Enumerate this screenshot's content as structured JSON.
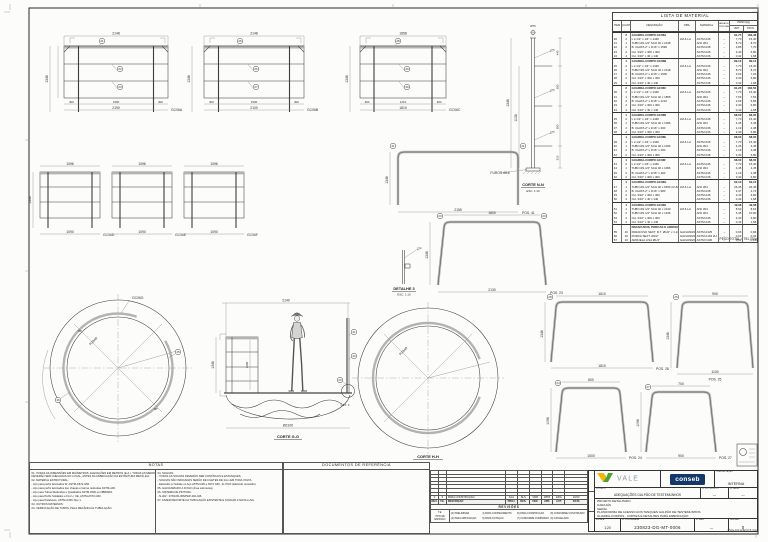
{
  "mat": {
    "title": "LISTA DE MATERIAL",
    "h_item": "ITEM",
    "h_qty": "QUANT.",
    "h_desc": "DESCRIÇÃO",
    "h_obs": "OBS.",
    "h_mat": "MATERIAL",
    "h_area": "ÁREA DE PINTURA",
    "h_peso": "PESO (kg)",
    "h_unit": "UNIT.",
    "h_total": "TOTAL",
    "groups": [
      {
        "qty": "2",
        "name": "GUARDA-CORPO GC06A",
        "unit": "91,74",
        "total": "183,48",
        "rows": [
          [
            "20",
            "2",
            "L 2.1/2\" x 1/4\" x 1346",
            "LM & LA",
            "ASTM A36",
            "–",
            "7,70",
            "15,40"
          ],
          [
            "21",
            "1",
            "TUBO Ø1.1/2\" SCH 40 x 2148",
            "",
            "AISI 304",
            "–",
            "8,70",
            "8,70"
          ],
          [
            "22",
            "2",
            "B. CHATA 2\" x 3/16\" x 1590",
            "",
            "ASTM A36",
            "–",
            "3,85",
            "7,70"
          ],
          [
            "23",
            "2",
            "CH. 3/16\" x 300 x 300",
            "",
            "ASTM A36",
            "–",
            "3,40",
            "6,80"
          ],
          [
            "24",
            "4",
            "CH. 3/16\" x 40 x 140",
            "",
            "ASTM A36",
            "–",
            "0,42",
            "1,68"
          ]
        ]
      },
      {
        "qty": "1",
        "name": "GUARDA-CORPO GC06B",
        "unit": "89,10",
        "total": "89,10",
        "rows": [
          [
            "25",
            "2",
            "L 2.1/2\" x 1/4\" x 1346",
            "LM & LA",
            "ASTM A36",
            "–",
            "7,70",
            "15,40"
          ],
          [
            "26",
            "1",
            "TUBO Ø1.1/2\" SCH 40 x 2148",
            "",
            "AISI 304",
            "–",
            "8,70",
            "8,70"
          ],
          [
            "27",
            "2",
            "B. CHATA 2\" x 3/16\" x 1500",
            "",
            "ASTM A36",
            "–",
            "3,63",
            "7,26"
          ],
          [
            "28",
            "2",
            "CH. 3/16\" x 300 x 300",
            "",
            "ASTM A36",
            "–",
            "3,40",
            "6,80"
          ],
          [
            "29",
            "4",
            "CH. 3/16\" x 40 x 140",
            "",
            "ASTM A36",
            "–",
            "0,42",
            "1,68"
          ]
        ]
      },
      {
        "qty": "2",
        "name": "GUARDA-CORPO GC06C",
        "unit": "81,25",
        "total": "162,50",
        "rows": [
          [
            "30",
            "2",
            "L 2.1/2\" x 1/4\" x 1346",
            "LM & LA",
            "ASTM A36",
            "–",
            "7,70",
            "15,40"
          ],
          [
            "31",
            "1",
            "TUBO Ø1.1/2\" SCH 40 x 1858",
            "",
            "AISI 304",
            "–",
            "7,53",
            "7,53"
          ],
          [
            "32",
            "2",
            "B. CHATA 2\" x 3/16\" x 1210",
            "",
            "ASTM A36",
            "–",
            "2,93",
            "5,86"
          ],
          [
            "33",
            "2",
            "CH. 3/16\" x 300 x 300",
            "",
            "ASTM A36",
            "–",
            "3,40",
            "6,80"
          ],
          [
            "34",
            "4",
            "CH. 3/16\" x 40 x 140",
            "",
            "ASTM A36",
            "–",
            "0,42",
            "1,68"
          ]
        ]
      },
      {
        "qty": "1",
        "name": "GUARDA-CORPO GC06D",
        "unit": "68,00",
        "total": "68,00",
        "rows": [
          [
            "35",
            "2",
            "L 2.1/2\" x 1/4\" x 1346",
            "LM & LA",
            "ASTM A36",
            "–",
            "7,70",
            "15,40"
          ],
          [
            "36",
            "1",
            "TUBO Ø1.1/2\" SCH 40 x 1096",
            "",
            "AISI 304",
            "–",
            "4,45",
            "4,45"
          ],
          [
            "37",
            "2",
            "B. CHATA 2\" x 3/16\" x 490",
            "",
            "ASTM A36",
            "–",
            "1,19",
            "2,38"
          ],
          [
            "38",
            "2",
            "CH. 3/16\" x 300 x 300",
            "",
            "ASTM A36",
            "–",
            "3,40",
            "6,80"
          ]
        ]
      },
      {
        "qty": "1",
        "name": "GUARDA-CORPO GC06E",
        "unit": "68,00",
        "total": "68,00",
        "rows": [
          [
            "39",
            "2",
            "L 2.1/2\" x 1/4\" x 1346",
            "LM & LA",
            "ASTM A36",
            "–",
            "7,70",
            "15,40"
          ],
          [
            "40",
            "1",
            "TUBO Ø1.1/2\" SCH 40 x 1096",
            "",
            "AISI 304",
            "–",
            "4,45",
            "4,45"
          ],
          [
            "41",
            "2",
            "B. CHATA 2\" x 3/16\" x 490",
            "",
            "ASTM A36",
            "–",
            "1,19",
            "2,38"
          ],
          [
            "42",
            "2",
            "CH. 3/16\" x 300 x 300",
            "",
            "ASTM A36",
            "–",
            "3,40",
            "6,80"
          ]
        ]
      },
      {
        "qty": "1",
        "name": "GUARDA-CORPO GC06F",
        "unit": "68,00",
        "total": "68,00",
        "rows": [
          [
            "43",
            "2",
            "L 2.1/2\" x 1/4\" x 1346",
            "LM & LA",
            "ASTM A36",
            "–",
            "7,70",
            "15,40"
          ],
          [
            "44",
            "1",
            "TUBO Ø1.1/2\" SCH 40 x 1096",
            "",
            "AISI 304",
            "–",
            "4,45",
            "4,45"
          ],
          [
            "45",
            "2",
            "B. CHATA 2\" x 3/16\" x 490",
            "",
            "ASTM A36",
            "–",
            "1,19",
            "2,38"
          ],
          [
            "46",
            "2",
            "CH. 3/16\" x 300 x 300",
            "",
            "ASTM A36",
            "–",
            "3,40",
            "6,80"
          ]
        ]
      },
      {
        "qty": "1",
        "name": "GUARDA-CORPO GC06G",
        "unit": "62,10",
        "total": "62,10",
        "rows": [
          [
            "47",
            "1",
            "TUBO Ø1.1/2\" SCH 40 x 6530 (CURV.)",
            "LM & LA",
            "AISI 304",
            "–",
            "26,45",
            "26,45"
          ],
          [
            "48",
            "2",
            "B. CHATA 2\" x 3/16\" x 980",
            "",
            "ASTM A36",
            "–",
            "2,37",
            "4,74"
          ],
          [
            "49",
            "2",
            "CH. 3/16\" x 300 x 300",
            "",
            "ASTM A36",
            "–",
            "3,40",
            "6,80"
          ],
          [
            "50",
            "4",
            "CH. 3/16\" x 40 x 140",
            "",
            "ASTM A36",
            "–",
            "0,42",
            "1,68"
          ]
        ]
      },
      {
        "qty": "1",
        "name": "GUARDA-CORPO GC06H",
        "unit": "49,08",
        "total": "49,08",
        "rows": [
          [
            "51",
            "1",
            "TUBO Ø1.1/2\" SCH 40 x 2130",
            "LM & LA",
            "AISI 304",
            "–",
            "8,63",
            "8,63"
          ],
          [
            "52",
            "2",
            "TUBO Ø1.1/2\" SCH 40 x 1346",
            "",
            "AISI 304",
            "–",
            "5,45",
            "10,90"
          ],
          [
            "53",
            "2",
            "CH. 3/16\" x 300 x 300",
            "",
            "ASTM A36",
            "–",
            "3,40",
            "6,80"
          ],
          [
            "54",
            "4",
            "CH. 3/16\" x 40 x 140",
            "",
            "ASTM A36",
            "–",
            "0,42",
            "1,68"
          ]
        ]
      }
    ],
    "extras_title": "PARAFUSOS, PORCAS E ARRUELAS",
    "extras": [
      [
        "55",
        "16",
        "PARAFUSO SEXT. R.T. Ø1/2\" x 1.1/2\"",
        "GALVANIZADO",
        "ASTM A325",
        "–",
        "0,06",
        "0,96"
      ],
      [
        "56",
        "16",
        "PORCA SEXT. Ø1/2\"",
        "GALVANIZADO",
        "ASTM A194 2H",
        "–",
        "0,02",
        "0,32"
      ],
      [
        "57",
        "16",
        "ARRUELA LISA Ø1/2\"",
        "GALVANIZADO",
        "ASTM F436",
        "–",
        "0,01",
        "0,16"
      ]
    ],
    "total": "PESO TOTAL = 751,70 kg"
  },
  "notes": {
    "title": "NOTAS",
    "col1": [
      "01- TODAS AS DIMENSÕES EM MILÍMETROS, ELEVAÇÕES EM METROS (E.A.). TODAS AS MEDIDAS",
      "      DEVERÃO SER CHECADAS NO LOCAL, ANTES DA FABRICAÇÃO DA ESTRUTURA METÁLICA.",
      "02- MATERIAL ESTRUTURAL:",
      "      - Aço para perfis laminados W, ASTM-A572-G50.",
      "      - Aço para perfis laminados tipo chapas e barras redondas ASTM-A36.",
      "      - Aço para Tubos Redondos e Quadrados ASTM A500 ou NBR8261.",
      "      - Aço para Perfis Soldados e FLs U, UE, ASTM-A572-G50.",
      "      - Aço para Parafusos, ASTM-A325-Tipo 1.",
      "03- OUTROS MATERIAIS:",
      "04- VERIFICAÇÃO DE TUBOS, PELA MECÂNICA E TUBULAÇÃO."
    ],
    "col2": [
      "04- SOLDAS:",
      "      - TODAS AS SOLDAS DEVERÃO SER CONTÍNUAS E ESTANQUES.",
      "      - SOLDAS NÃO INDICADAS SERÃO DE FILETES DE 3mm EM TODA VOLTA.",
      "      - Eletrodos p/ Soldas no Aço ASTM A36 e A572 G50 - E-70XX (Eletrodo revestido).",
      "05- GALVANIZADO A FOGO (Área submersa).",
      "06- SISTEMA DE PINTURA:",
      "      - N-402 : 07/01/00-006/PEP-402-046.",
      "07- FAZER RECORTE NA TUBULAÇÃO EXISTENTE E SOLDAR A NOVA LUVA."
    ]
  },
  "docs": {
    "title": "DOCUMENTOS DE REFERÊNCIA"
  },
  "rev": {
    "caption": "REVISÕES",
    "headers": [
      "REV.",
      "T.E.",
      "DESCRIÇÃO",
      "PROJ.",
      "DES.",
      "VER.",
      "APR.",
      "AUT.",
      "DATA"
    ],
    "row": [
      "0",
      "6",
      "PARA CONSTRUÇÃO",
      "SLA",
      "SLS",
      "VDR",
      "WPR",
      "ERG",
      "10/23"
    ],
    "legend_label": [
      "T.E.",
      "TIPO DE",
      "EMISSÃO"
    ],
    "legend": [
      "(0) PRELIMINAR",
      "(4) PARA CONHECIMENTO",
      "(6) PARA CONSTRUÇÃO",
      "(8) CONFORME CONSTRUÍDO",
      "(2) PARA APROVAÇÃO",
      "(5) PARA COTAÇÃO",
      "(7) CONFORME COMPRADO",
      "(9) CANCELADO"
    ]
  },
  "tb": {
    "vale": "VALE",
    "conseb": "conseb",
    "class_label": "CLASSIFICAÇÃO",
    "class_value": "INTERNA",
    "proj_label": "PROJETO",
    "proj_value": "ADEQUAÇÕES GALPÃO DE TESTEMUNHOS",
    "nproj_label": "Nº DO PROJETO",
    "nproj_value": "—",
    "nse_label": "Nº DA SE",
    "nse_value": "—",
    "body": [
      "PROJETO DETALHADO",
      "CARAJÁS",
      "GERAL",
      "PLATAFORMA DE ACESSO AOS TANQUES GALPÃO DE TESTEMUNHOS",
      "GUARDA-CORPOS - CORTES E DETALHES PARA FABRICAÇÃO"
    ],
    "escala_label": "ESCALA",
    "escala": "1:20",
    "ncontr_label": "Nº CONTRATADA",
    "ncontr": "230823-DG-MT-0006",
    "nvale_label": "Nº VALE",
    "nvale": "—",
    "rev_label": "REVISÃO",
    "rev": "0",
    "footnote": "PM-E-102 ANEXO B (A1)"
  },
  "dwg": {
    "fA": {
      "top": "2148",
      "h": "1346",
      "s1": "300",
      "mid": "1590",
      "s2": "300",
      "tot": "2190",
      "label": "GC06A",
      "b1": "21",
      "b2": "22",
      "b3": "23"
    },
    "fB": {
      "top": "2148",
      "h": "1346",
      "s1": "300",
      "mid": "1500",
      "s2": "300",
      "tot": "2100",
      "label": "GC06B",
      "b1": "25",
      "b2": "26",
      "b3": "27"
    },
    "fC": {
      "top": "1858",
      "h": "1346",
      "s1": "300",
      "mid": "1210",
      "s2": "300",
      "tot": "1810",
      "label": "GC06C",
      "b1": "28",
      "b2": "29",
      "b3": "30"
    },
    "fD": {
      "top": "1096",
      "tot": "1090",
      "label": "GC06D",
      "h": "1346"
    },
    "fE": {
      "top": "1096",
      "tot": "1090",
      "label": "GC06E"
    },
    "fF": {
      "top": "1096",
      "tot": "1090",
      "label": "GC06F"
    },
    "u41": {
      "bot": "2155",
      "pos": "POS. 41",
      "h": "1346",
      "b": "41"
    },
    "u23": {
      "top": "1800",
      "bot": "2130",
      "pos": "POS. 23",
      "h": "1346",
      "b": "23"
    },
    "u28": {
      "top": "1610",
      "bot": "1810",
      "pos": "POS. 28",
      "h": "1346",
      "b": "28"
    },
    "u25": {
      "top": "900",
      "bot": "1100",
      "pos": "POS. 25",
      "h": "1346",
      "b": "25"
    },
    "u24": {
      "top": "800",
      "bot": "1000",
      "pos": "POS. 24",
      "h": "1096",
      "b": "24"
    },
    "u27": {
      "top": "700",
      "bot": "900",
      "pos": "POS. 27",
      "h": "1096",
      "b": "27"
    },
    "post": {
      "h1": "1346",
      "h2": "1138",
      "d1": "440",
      "d2": "300",
      "d3": "390",
      "d4": "216",
      "top": "Ø76",
      "furos": "FUROS Ø16",
      "cap": "CORTE N-N",
      "esc": "ESC. 1:10"
    },
    "det3": {
      "cap": "DETALHE 3",
      "esc": "ESC. 1:10"
    },
    "ring": {
      "label": "GC06G",
      "r": "R1040",
      "a1": "45°",
      "a2": "30°",
      "b1": "45",
      "b2": "46"
    },
    "c2": {
      "cap": "CORTE H-H",
      "r": "R1040"
    },
    "per": {
      "top": "2140",
      "h": "1346",
      "h2": "1200",
      "bot": "Ø2100",
      "cap": "CORTE G-G",
      "det": "DET. 3",
      "b1": "41",
      "b2": "42",
      "b3": "23"
    }
  }
}
